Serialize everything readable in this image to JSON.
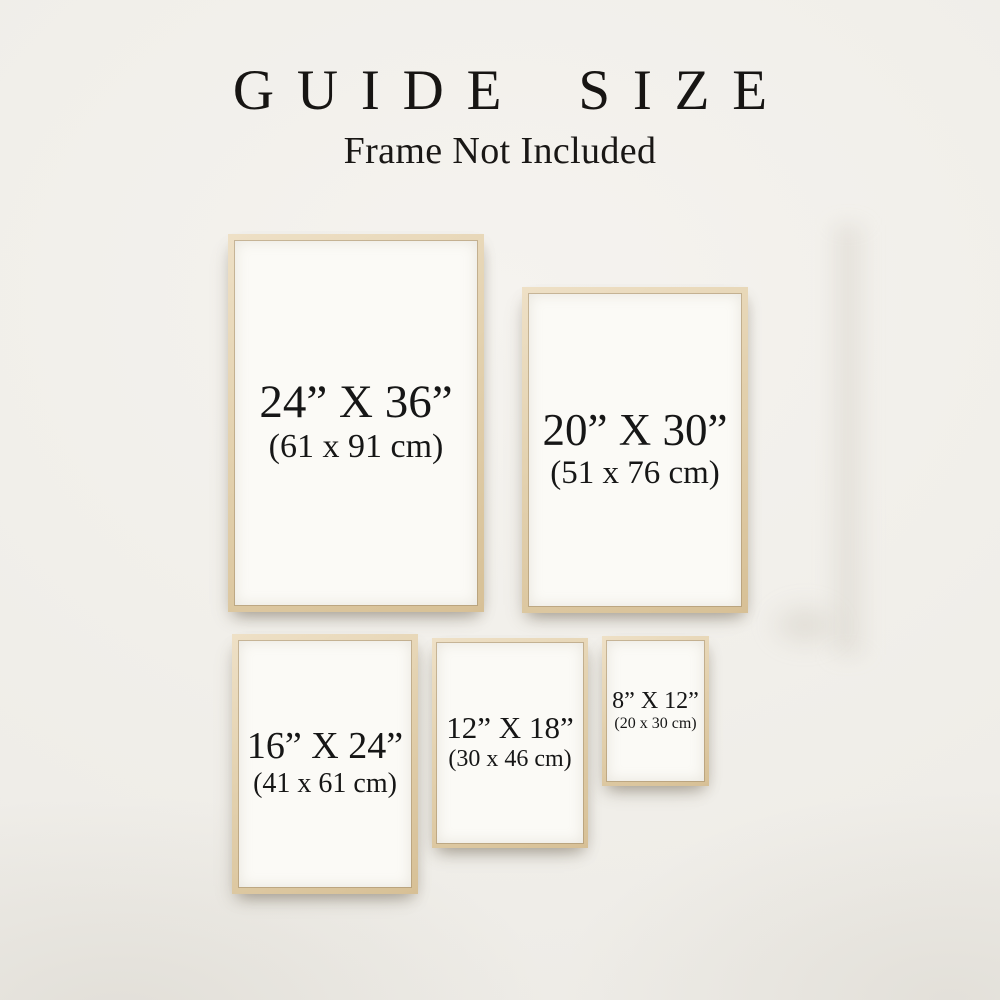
{
  "header": {
    "title": "GUIDE SIZE",
    "subtitle": "Frame Not Included"
  },
  "frames": [
    {
      "name": "24x36",
      "inches": "24” X 36”",
      "centimeters": "(61 x 91 cm)"
    },
    {
      "name": "20x30",
      "inches": "20” X 30”",
      "centimeters": "(51 x 76 cm)"
    },
    {
      "name": "16x24",
      "inches": "16” X 24”",
      "centimeters": "(41 x 61 cm)"
    },
    {
      "name": "12x18",
      "inches": "12” X 18”",
      "centimeters": "(30 x 46 cm)"
    },
    {
      "name": "8x12",
      "inches": "8” X 12”",
      "centimeters": "(20 x 30 cm)"
    }
  ],
  "colors": {
    "background": "#f1efea",
    "frame_wood": "#e0cda8",
    "poster": "#fbfaf6",
    "text": "#161616"
  }
}
